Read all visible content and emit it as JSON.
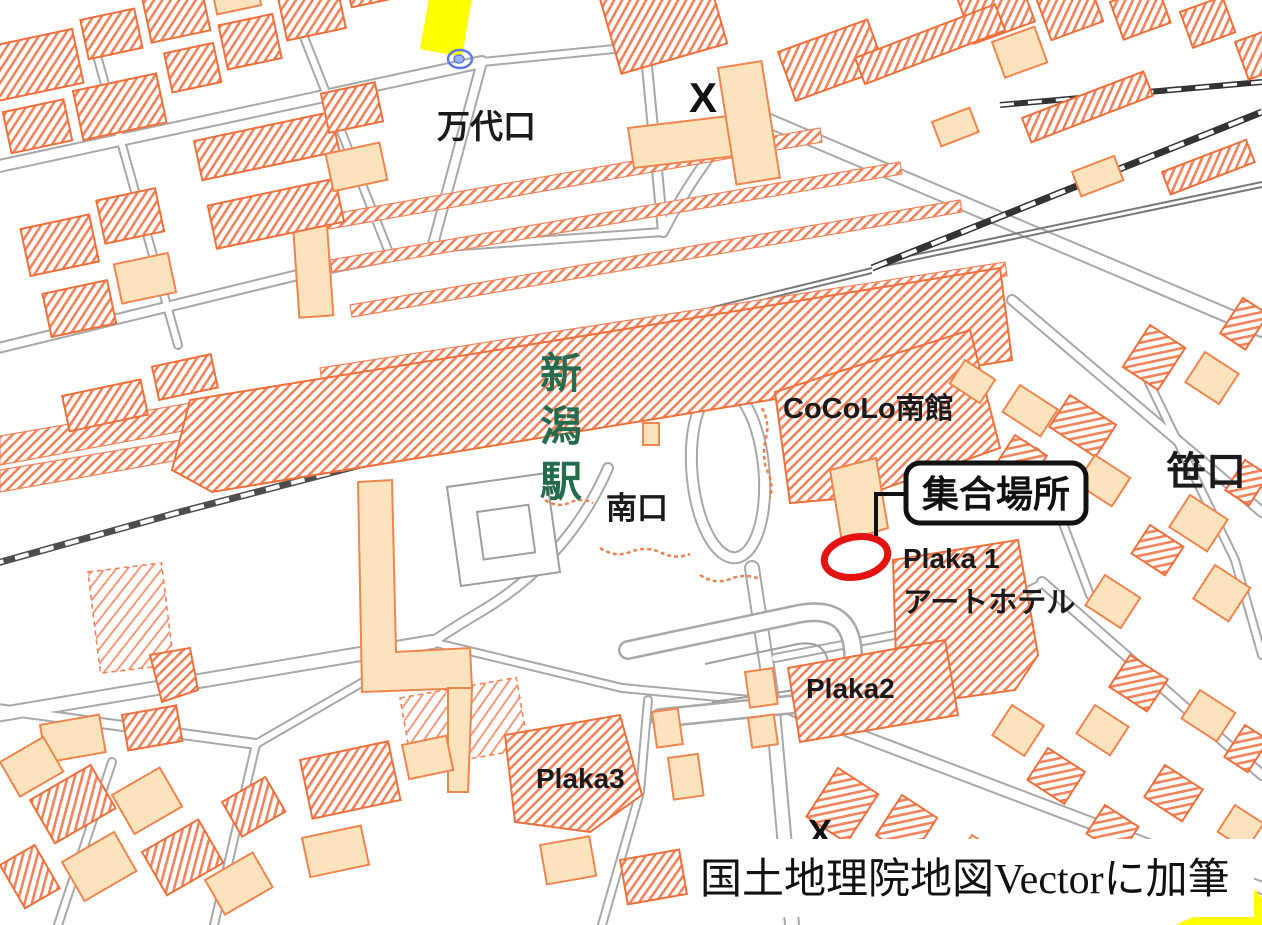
{
  "map": {
    "source_note": "国土地理院地図Vectorに加筆",
    "labels": {
      "bandai_exit": "万代口",
      "station_chars": [
        "新",
        "潟",
        "駅"
      ],
      "south_exit": "南口",
      "cocolo_south": "CoCoLo南館",
      "plaka1": "Plaka 1",
      "art_hotel": "アートホテル",
      "plaka2": "Plaka2",
      "plaka3": "Plaka3",
      "sasaguchi": "笹口",
      "crossing_mark": "X"
    },
    "annotations": {
      "meeting_place": "集合場所"
    },
    "colors": {
      "building_hatch": "#F2835B",
      "building_outline": "#F0703C",
      "building_solid": "#FBE3BE",
      "road_casing": "#A8A8A8",
      "railway": "#4D4D4D",
      "station_text_green": "#276B4E",
      "annotation_red": "#E51212",
      "highlight_yellow": "#FFFF00",
      "fountain_blue": "#5B7BE8"
    }
  }
}
